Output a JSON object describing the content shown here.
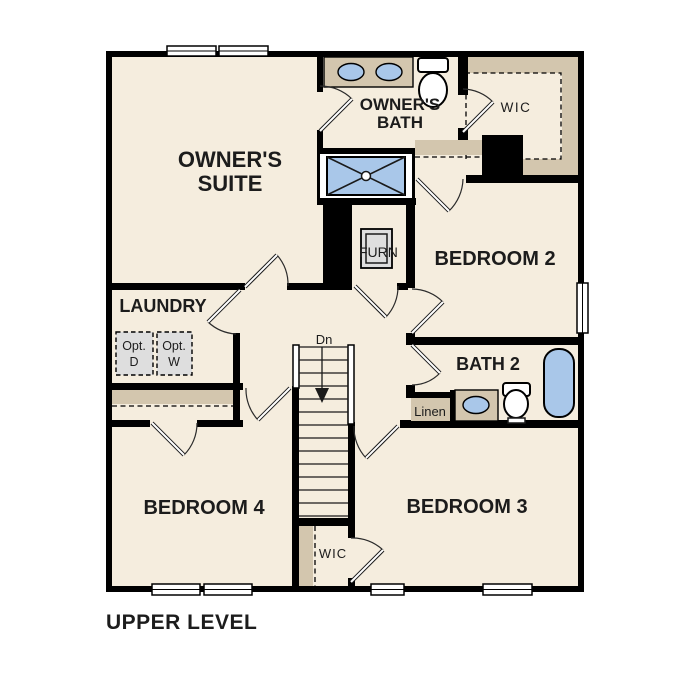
{
  "title": "UPPER LEVEL",
  "rooms": {
    "owners_suite": {
      "line1": "OWNER'S",
      "line2": "SUITE"
    },
    "owners_bath": {
      "line1": "OWNER'S",
      "line2": "BATH"
    },
    "wic_top": "WIC",
    "bedroom2": "BEDROOM 2",
    "bath2": "BATH 2",
    "linen": "Linen",
    "laundry": "LAUNDRY",
    "furn": "FURN",
    "bedroom4": "BEDROOM 4",
    "bedroom3": "BEDROOM 3",
    "wic_bottom": "WIC",
    "stairs_dn": "Dn",
    "opt_d": {
      "line1": "Opt.",
      "line2": "D"
    },
    "opt_w": {
      "line1": "Opt.",
      "line2": "W"
    }
  },
  "colors": {
    "bg": "#ffffff",
    "wall": "#000000",
    "floor": "#f5edde",
    "shelf": "#d3c6ae",
    "fixture_blue": "#a9c7e9",
    "fixture_gray": "#dedede",
    "label": "#1c1c1c"
  }
}
